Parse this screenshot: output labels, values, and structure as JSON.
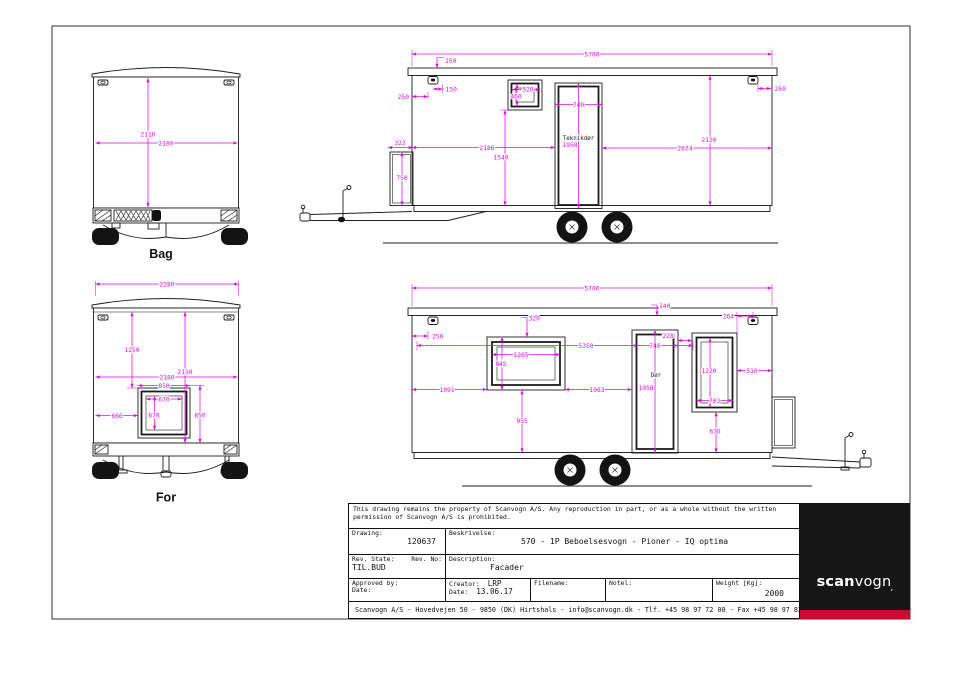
{
  "colors": {
    "dimension": "#e00ce0",
    "line": "#1b1b1b",
    "logo_bg": "#161616",
    "logo_red": "#c60d33",
    "page_bg": "#ffffff"
  },
  "views": {
    "bag": {
      "label": "Bag",
      "h": "2110",
      "w": "2180"
    },
    "front": {
      "label": "For",
      "d2280": "2280",
      "d1250": "1250",
      "d2110": "2110",
      "d2180": "2180",
      "d850w": "850",
      "d670w": "670",
      "d666": "666",
      "d670h": "670",
      "d850h": "850"
    },
    "side_top": {
      "d5700": "5700",
      "d150_roof": "150",
      "d150_lamp": "150",
      "d250_front": "250",
      "dwin_w": "520",
      "dwin_h": "460",
      "ddoor_w": "740",
      "door_label": "Teknikdør",
      "ddoor_h": "1958",
      "d2186": "2186",
      "d1540": "1540",
      "d322": "322",
      "d750": "750",
      "d2674": "2674",
      "d2120": "2120",
      "d250_rear": "250"
    },
    "side_bottom": {
      "d5700": "5700",
      "d140": "140",
      "d264": "264",
      "d250": "250",
      "d320": "320",
      "d228": "228",
      "ddoor_w": "740",
      "d5350": "5350",
      "d1265": "1265",
      "d845": "845",
      "d1091": "1091",
      "d1063": "1063",
      "d955": "955",
      "door_label": "Dør",
      "ddoor_h": "1958",
      "d1220": "1220",
      "d510": "510",
      "d703": "703",
      "d636": "636"
    }
  },
  "title_block": {
    "disclaimer_line1": "This drawing remains the property of Scanvogn A/S. Any reproduction in part, or as a whole without the written",
    "disclaimer_line2": "permission of Scanvogn A/S is prohibited.",
    "drawing_label": "Drawing:",
    "drawing_number": "120637",
    "beskrivelse_label": "Beskrivelse:",
    "beskrivelse_value": "570 - 1P Beboelsesvogn - Pioner - IQ optima",
    "rev_state_label": "Rev. State:",
    "rev_no_label": "Rev. No:",
    "rev_state_value": "TIL.BUD",
    "description_label": "Description:",
    "description_value": "Facader",
    "approved_by_label": "Approved by:",
    "approved_date_label": "Date:",
    "creator_label": "Creator:",
    "creator_value": "LRP",
    "creator_date_label": "Date:",
    "creator_date_value": "13.06.17",
    "filename_label": "Filename:",
    "note_label": "Notel:",
    "weight_label": "Weight [Kg]:",
    "weight_value": "2000",
    "footer": "Scanvogn A/S - Hovedvejen 50 - 9850 (DK) Hirtshals - info@scanvogn.dk - Tlf. +45 98 97 72 00 - Fax +45 98 97 82 00"
  },
  "logo": {
    "part1": "scan",
    "part2": "vogn",
    "tail": "‚"
  }
}
